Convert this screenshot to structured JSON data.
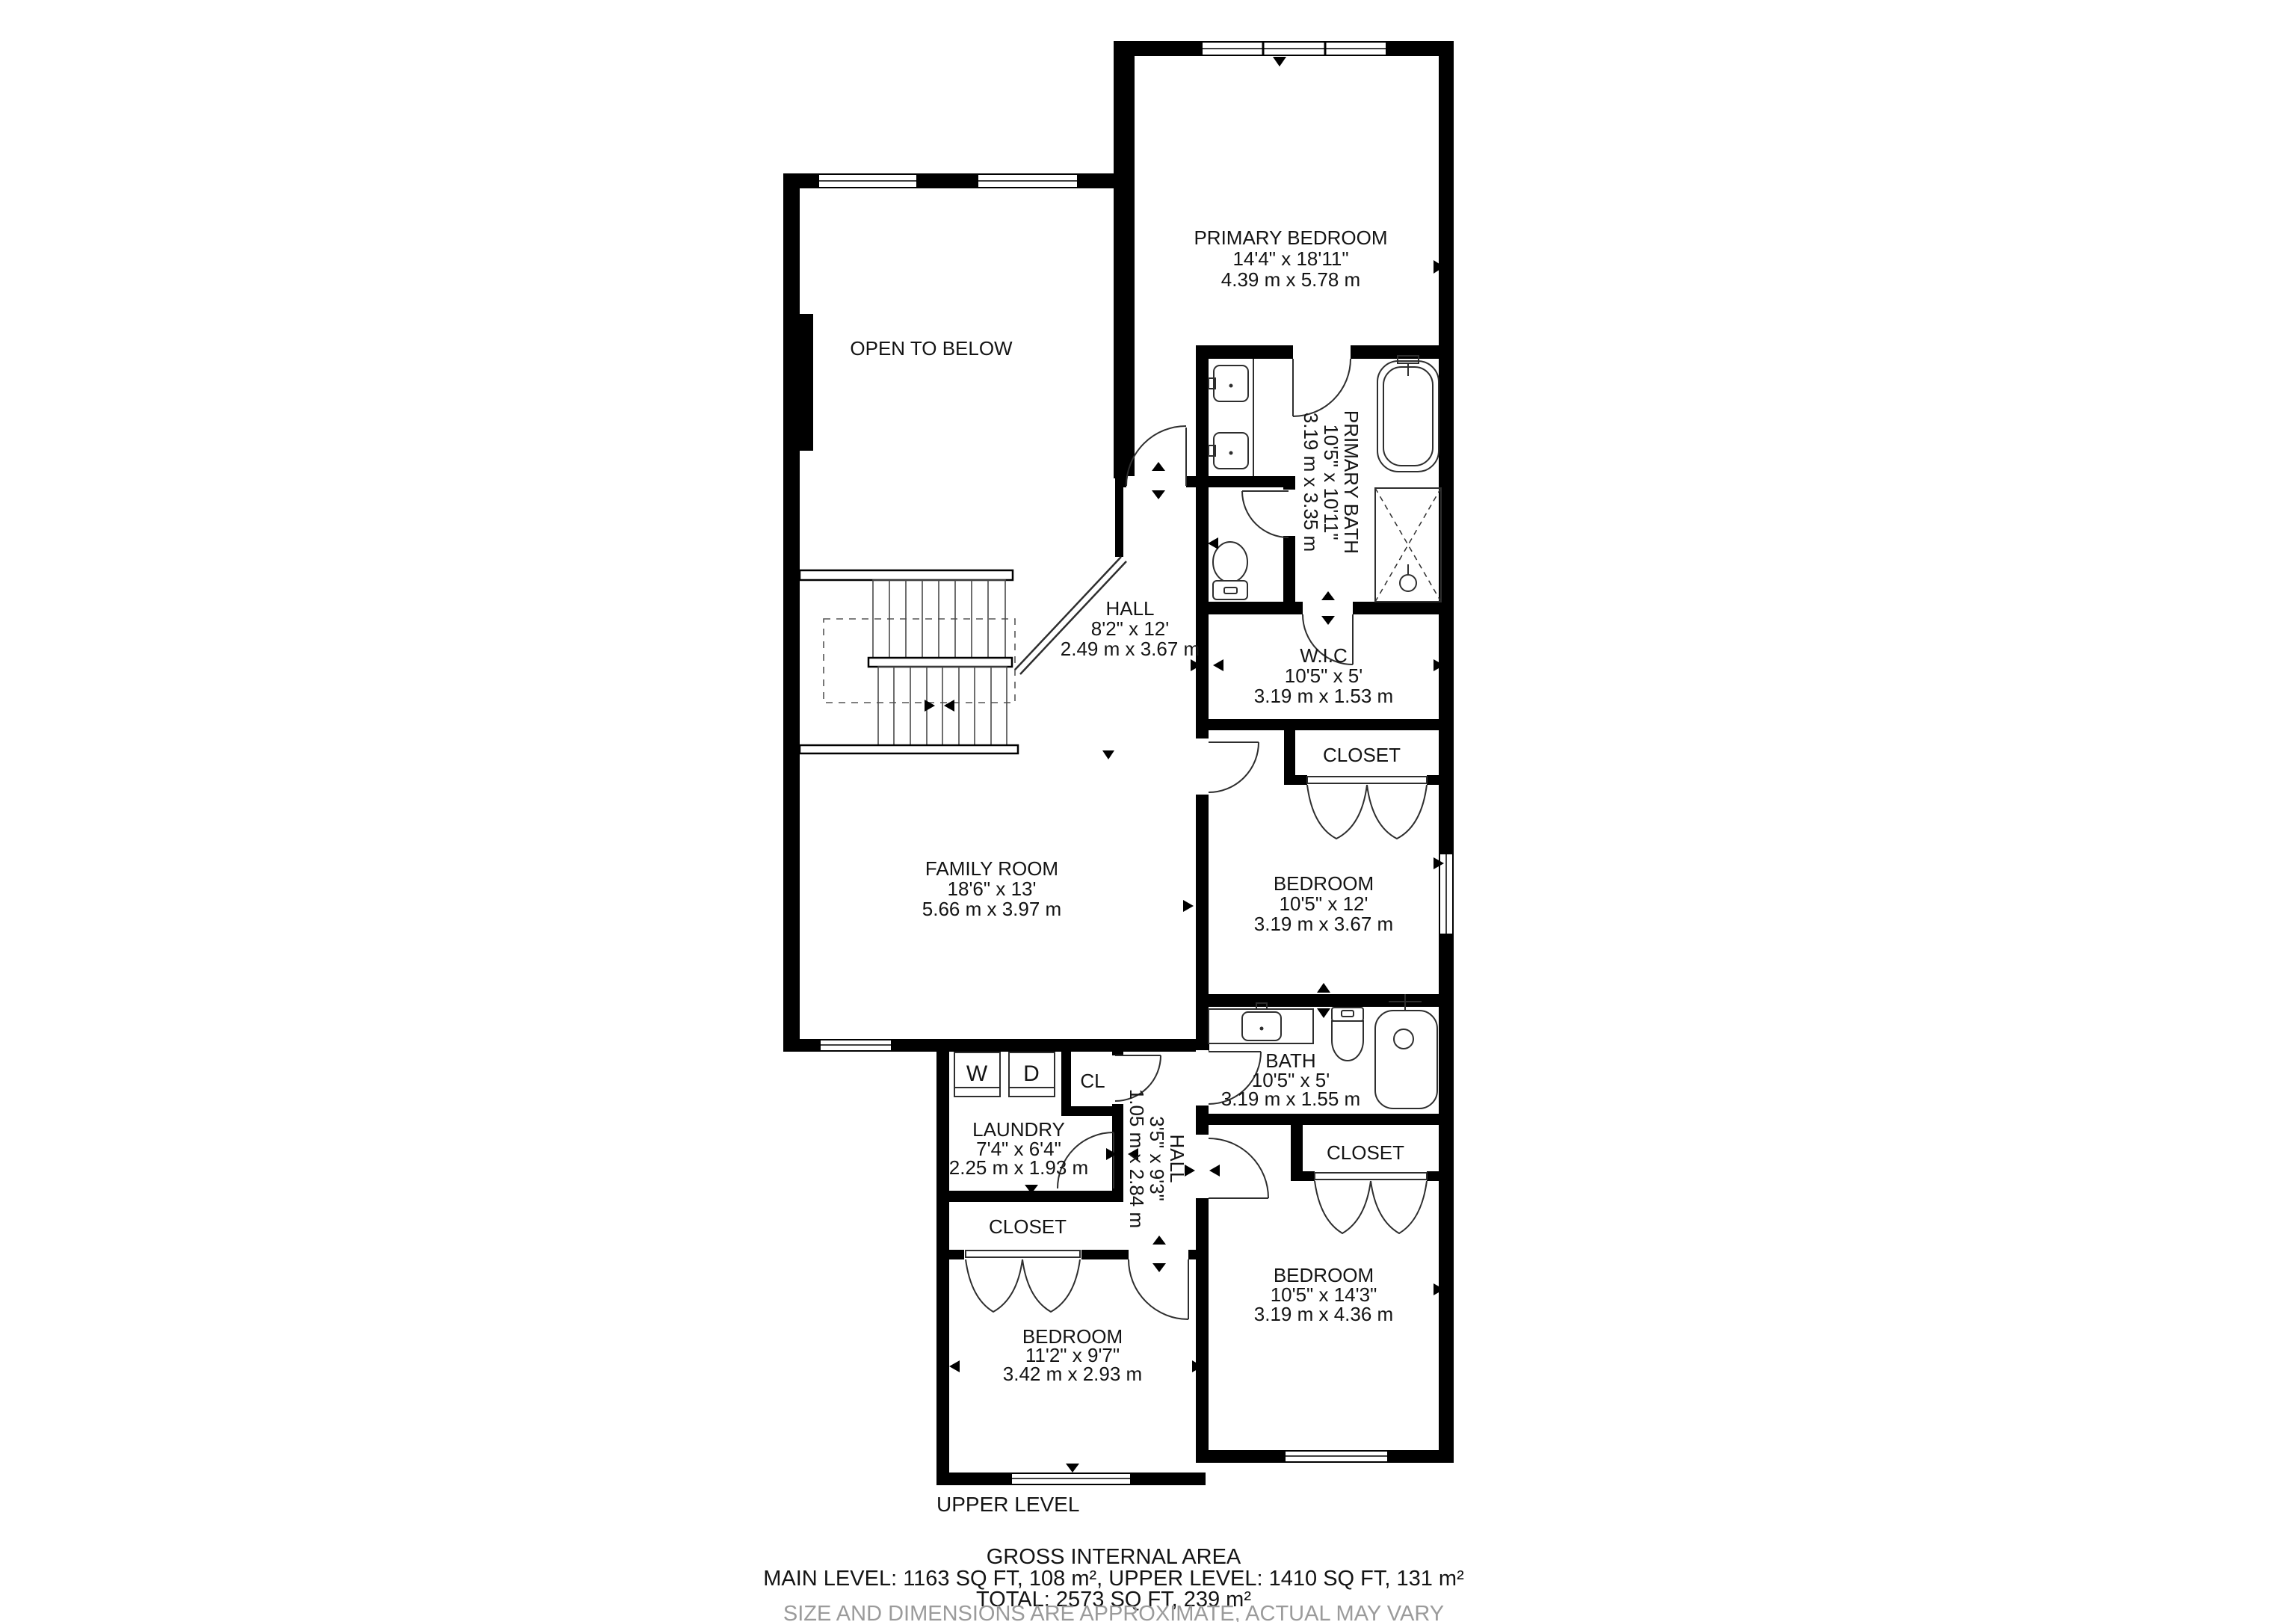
{
  "rooms": {
    "open_to_below": {
      "name": "OPEN TO BELOW"
    },
    "primary_bedroom": {
      "name": "PRIMARY BEDROOM",
      "imperial": "14'4\" x 18'11\"",
      "metric": "4.39 m x 5.78 m"
    },
    "primary_bath": {
      "name": "PRIMARY BATH",
      "imperial": "10'5\" x 10'11\"",
      "metric": "3.19 m x 3.35 m"
    },
    "hall_upper": {
      "name": "HALL",
      "imperial": "8'2\" x 12'",
      "metric": "2.49 m x 3.67 m"
    },
    "wic": {
      "name": "W.I.C",
      "imperial": "10'5\" x 5'",
      "metric": "3.19 m x 1.53 m"
    },
    "closet_mid_bedroom": {
      "name": "CLOSET"
    },
    "bedroom_mid": {
      "name": "BEDROOM",
      "imperial": "10'5\" x 12'",
      "metric": "3.19 m x 3.67 m"
    },
    "family_room": {
      "name": "FAMILY ROOM",
      "imperial": "18'6\" x 13'",
      "metric": "5.66 m x 3.97 m"
    },
    "bath": {
      "name": "BATH",
      "imperial": "10'5\" x 5'",
      "metric": "3.19 m x 1.55 m"
    },
    "laundry": {
      "name": "LAUNDRY",
      "imperial": "7'4\" x 6'4\"",
      "metric": "2.25 m x 1.93 m"
    },
    "hall_lower": {
      "name": "HALL",
      "imperial": "3'5\" x 9'3\"",
      "metric": "1.05 m x 2.84 m"
    },
    "closet_bottom_right": {
      "name": "CLOSET"
    },
    "bedroom_bottom_right": {
      "name": "BEDROOM",
      "imperial": "10'5\" x 14'3\"",
      "metric": "3.19 m x 4.36 m"
    },
    "closet_bottom_left": {
      "name": "CLOSET"
    },
    "bedroom_bottom_left": {
      "name": "BEDROOM",
      "imperial": "11'2\" x 9'7\"",
      "metric": "3.42 m x 2.93 m"
    },
    "cl_closet": {
      "name": "CL"
    }
  },
  "appliances": {
    "washer": "W",
    "dryer": "D"
  },
  "footer": {
    "level_label": "UPPER LEVEL",
    "title": "GROSS INTERNAL AREA",
    "areas_line": "MAIN LEVEL: 1163 SQ FT, 108 m², UPPER LEVEL: 1410 SQ FT, 131 m²",
    "total_line": "TOTAL: 2573 SQ FT, 239 m²",
    "disclaimer": "SIZE AND DIMENSIONS ARE APPROXIMATE, ACTUAL MAY VARY"
  },
  "colors": {
    "walls": "#000000",
    "background": "#ffffff",
    "fixtures": "#2e2e2e",
    "text": "#141414",
    "disclaimer_text": "#9b9b9b"
  }
}
